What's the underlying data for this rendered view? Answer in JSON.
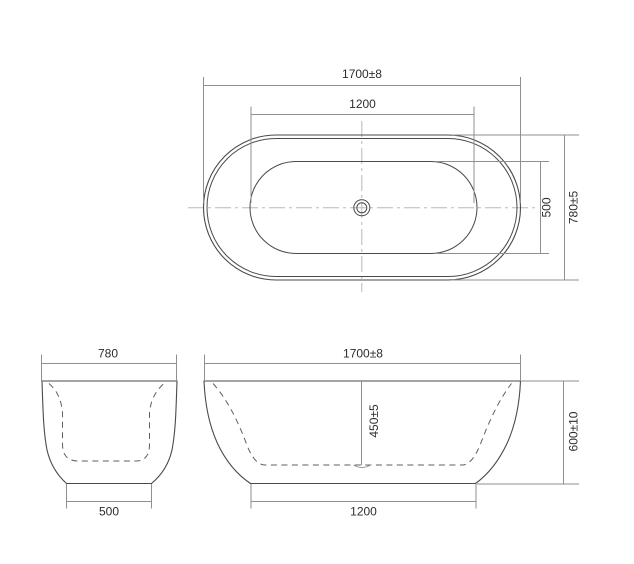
{
  "drawing": {
    "colors": {
      "outline": "#4a4a4a",
      "dashed": "#5f5f5f",
      "dimension": "#8f8f8f",
      "centerline": "#b8b8b8",
      "text": "#2d2d2d",
      "background": "#ffffff"
    },
    "views": {
      "top": {
        "dims": {
          "overall_length": "1700±8",
          "inner_length": "1200",
          "inner_width": "500",
          "overall_width": "780±5"
        }
      },
      "end": {
        "dims": {
          "overall_width": "780",
          "base_width": "500"
        }
      },
      "front": {
        "dims": {
          "overall_length": "1700±8",
          "inner_depth": "450±5",
          "overall_height": "600±10",
          "base_length": "1200"
        }
      }
    }
  }
}
